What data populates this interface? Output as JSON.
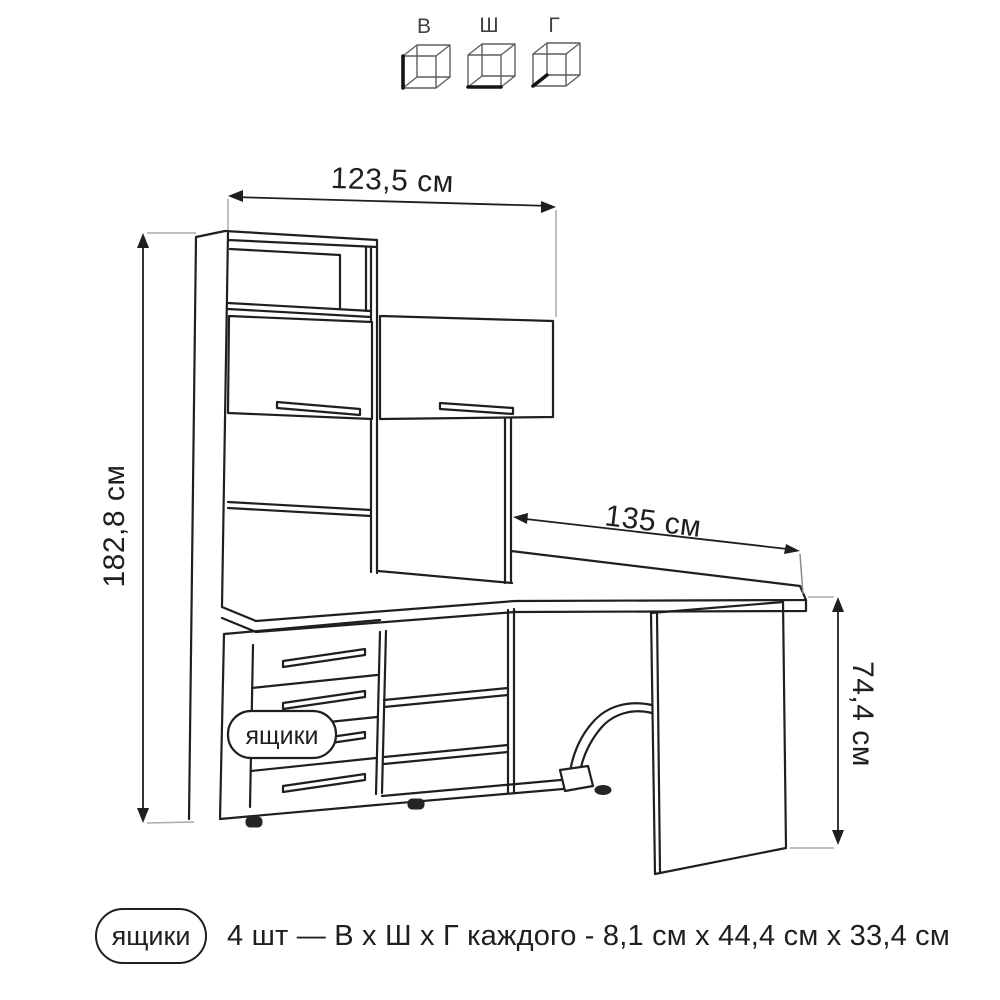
{
  "legend": {
    "cubes": [
      {
        "label": "В",
        "highlight": "height-edge"
      },
      {
        "label": "Ш",
        "highlight": "width-edge"
      },
      {
        "label": "Г",
        "highlight": "depth-edge"
      }
    ]
  },
  "dimensions": {
    "hutch_width": "123,5 см",
    "total_height": "182,8 см",
    "desk_depth": "135 см",
    "desk_height": "74,4 см"
  },
  "callout": {
    "label": "ящики"
  },
  "footer": {
    "badge": "ящики",
    "note": "4 шт — В х Ш х Г каждого - 8,1 см х 44,4 см х 33,4 см"
  },
  "colors": {
    "line": "#1f1f1f",
    "extension_line": "#ababab",
    "legend_cube": "#5f5f5f",
    "background": "#ffffff"
  }
}
